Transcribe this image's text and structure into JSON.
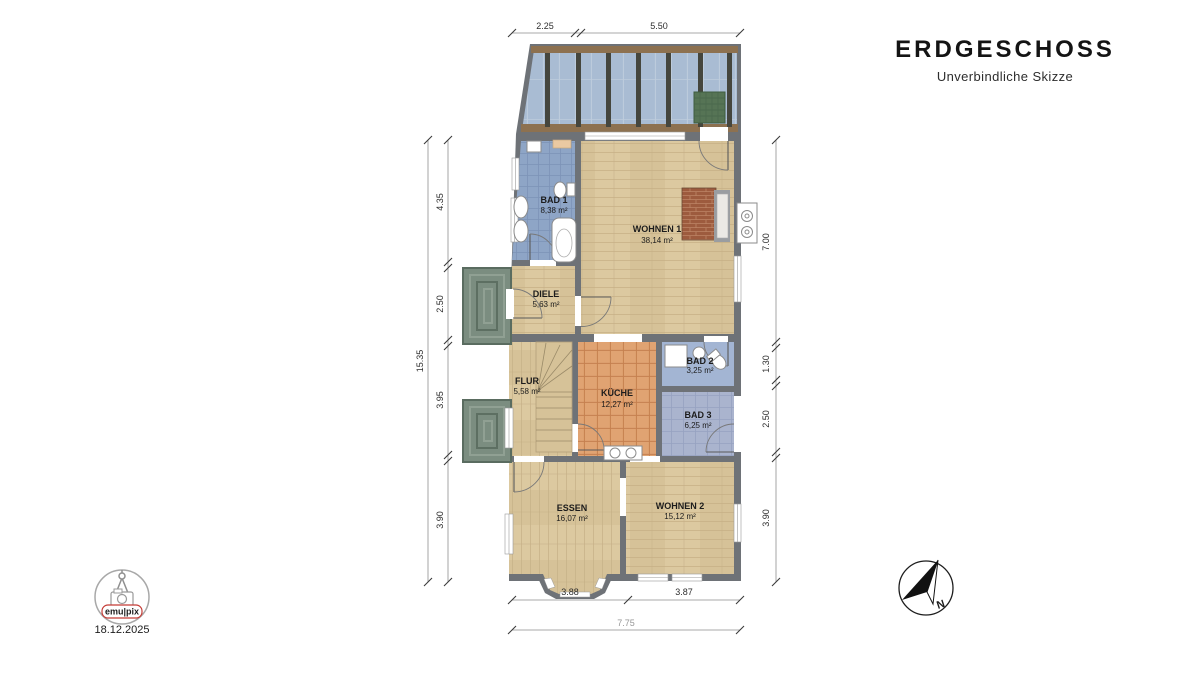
{
  "header": {
    "title": "ERDGESCHOSS",
    "subtitle": "Unverbindliche Skizze"
  },
  "rooms": {
    "bad1": {
      "name": "BAD 1",
      "area": "8,38 m²"
    },
    "wohnen1": {
      "name": "WOHNEN 1",
      "area": "38,14 m²"
    },
    "diele": {
      "name": "DIELE",
      "area": "5,63 m²"
    },
    "flur": {
      "name": "FLUR",
      "area": "5,58 m²"
    },
    "kueche": {
      "name": "KÜCHE",
      "area": "12,27 m²"
    },
    "bad2": {
      "name": "BAD 2",
      "area": "3,25 m²"
    },
    "bad3": {
      "name": "BAD 3",
      "area": "6,25 m²"
    },
    "essen": {
      "name": "ESSEN",
      "area": "16,07 m²"
    },
    "wohnen2": {
      "name": "WOHNEN 2",
      "area": "15,12 m²"
    }
  },
  "dims": {
    "top": {
      "a": "2.25",
      "b": "5.50"
    },
    "left": {
      "total": "15.35",
      "a": "4.35",
      "b": "2.50",
      "c": "3.95",
      "d": "3.90"
    },
    "right": {
      "a": "7.00",
      "b": "1.30",
      "c": "2.50",
      "d": "3.90"
    },
    "bottom": {
      "a": "3.88",
      "b": "3.87",
      "total": "7.75"
    }
  },
  "branding": {
    "logo_text": "emu|pix",
    "date": "18.12.2025"
  },
  "compass": {
    "north_label": "N"
  },
  "colors": {
    "wall": "#6e7277",
    "wood": "#dcc9a0",
    "bath_tile": "#8ea5c6",
    "bath2": "#a3b5d3",
    "bath3_tile": "#aab4ce",
    "kitchen_tile": "#e0a372",
    "glass": "#a9bcd3",
    "beam": "#8d7150",
    "porch": "#7b8d80",
    "brick": "#9d5b3e",
    "plant": "#567455",
    "logo_red": "#c43b35"
  }
}
